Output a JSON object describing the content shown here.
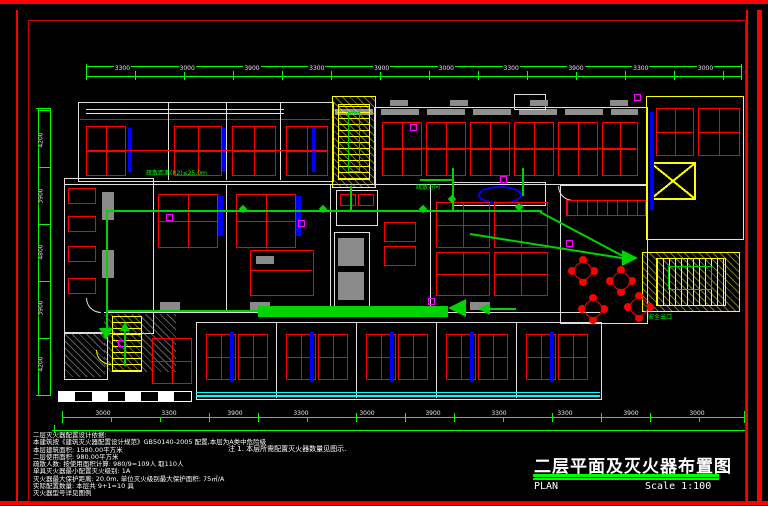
{
  "colors": {
    "red": "#ff0000",
    "dim": "#00ff00",
    "route": "#00d400",
    "yellow": "#ffff00",
    "blue": "#0000ff",
    "magenta": "#ff00ff",
    "cyan": "#00ffff"
  },
  "dimensions": {
    "top": [
      "3300",
      "3000",
      "3900",
      "3300",
      "3900",
      "3000",
      "3300",
      "3900",
      "3300",
      "3000"
    ],
    "bottom": [
      "3000",
      "3300",
      "3900",
      "3300",
      "3000",
      "3900",
      "3300",
      "3300",
      "3900",
      "3000"
    ],
    "left": [
      "4200",
      "3900",
      "4800",
      "3900",
      "4200"
    ]
  },
  "plan_labels": {
    "evac_distance": "疏散距离(R2)≤25.0m",
    "evac_direction": "疏散方向",
    "exit": "安全出口"
  },
  "notes": {
    "lines": [
      "二层灭火器配置设计依据:",
      "本建筑按《建筑灭火器配置设计规范》GB50140-2005 配置,本层为A类中危险级",
      "本层建筑面积: 1580.00平方米",
      "二层使用面积: 980.00平方米",
      "疏散人数: 按使用面积计算: 980/9=109人 取110人",
      "        单具灭火器最小配置灭火级别: 1A",
      "灭火器最大保护距离: 20.0m, 单位灭火级别最大保护面积: 75㎡/A",
      "实际配置数量: 本层共 9+1=10 具",
      "灭火器型号详见图例"
    ]
  },
  "center_note": "注 1. 本层所需配置灭火器数量见图示.",
  "title_block": {
    "title": "二层平面及灭火器布置图",
    "plan": "PLAN",
    "scale": "Scale 1:100"
  }
}
